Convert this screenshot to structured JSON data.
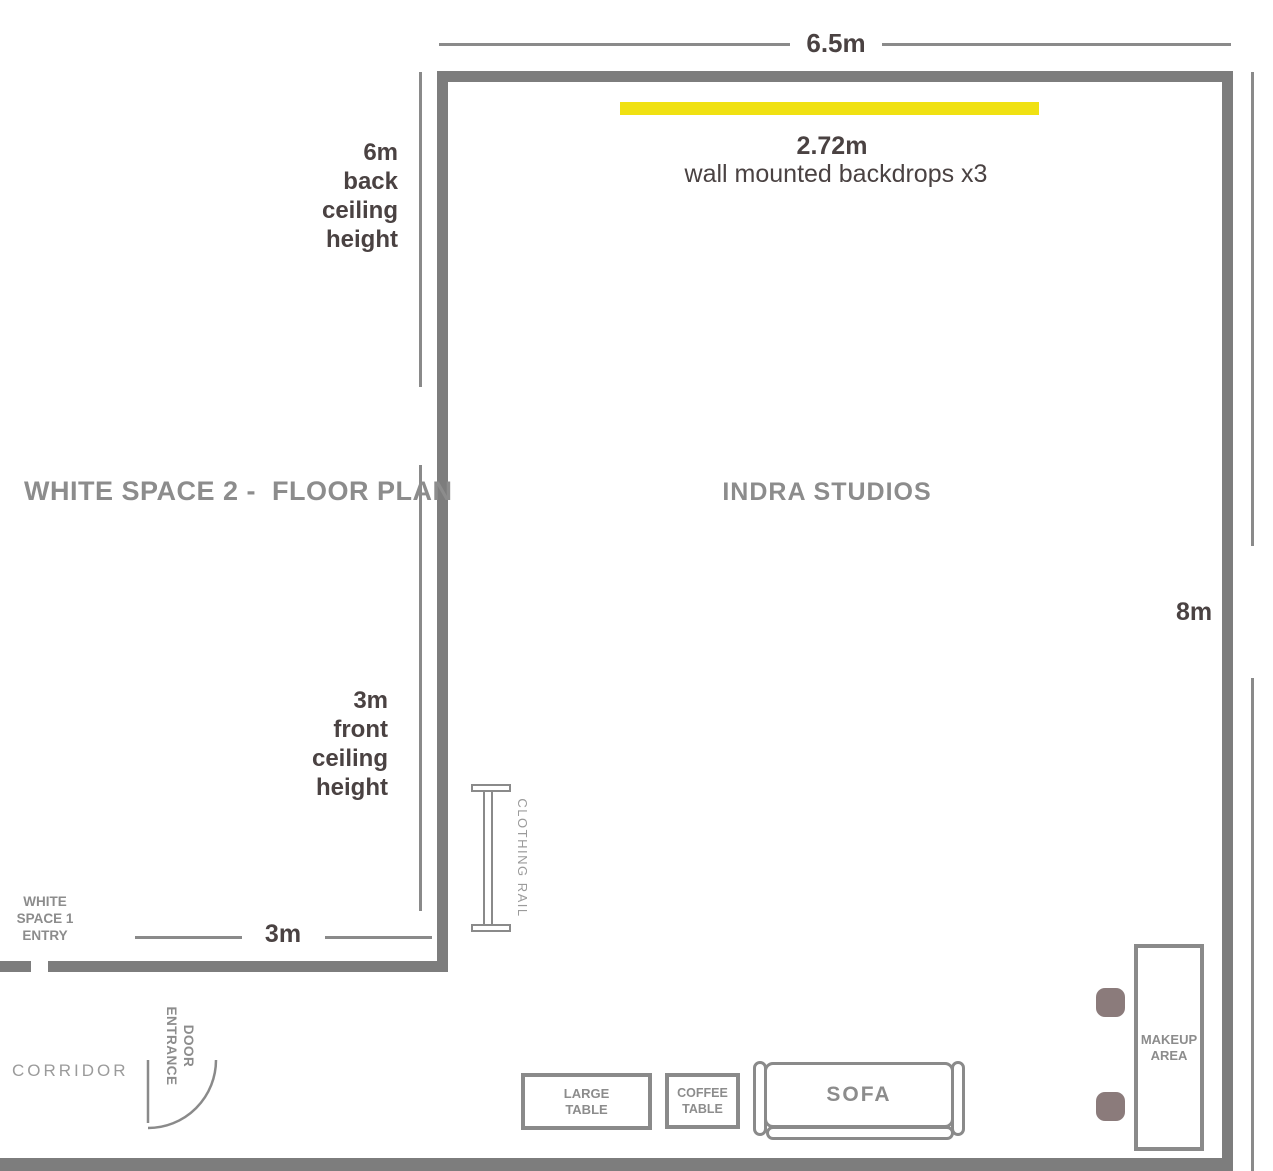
{
  "title": "WHITE SPACE 2 -  FLOOR PLAN",
  "studio": "INDRA STUDIOS",
  "dims": {
    "width_top": "6.5m",
    "height_right": "8m",
    "entry_bottom": "3m",
    "back_ceiling": "6m\nback\nceiling\nheight",
    "front_ceiling": "3m\nfront\nceiling\nheight",
    "backdrop_width": "2.72m",
    "backdrop_note": "wall mounted backdrops x3"
  },
  "labels": {
    "white_space_1_entry": "WHITE\nSPACE 1\nENTRY",
    "corridor": "CORRIDOR",
    "door_entrance": "DOOR\nENTRANCE",
    "clothing_rail": "CLOTHING RAIL"
  },
  "furniture": {
    "large_table": "LARGE\nTABLE",
    "coffee_table": "COFFEE\nTABLE",
    "sofa": "SOFA",
    "makeup_area": "MAKEUP\nAREA"
  },
  "colors": {
    "wall": "#7d7d7d",
    "line": "#8a8a8a",
    "dark_text": "#4a4242",
    "gray_text": "#8c8c8c",
    "light_text": "#9b9b9b",
    "backdrop": "#f0e112",
    "stool": "#8b7b7b"
  }
}
